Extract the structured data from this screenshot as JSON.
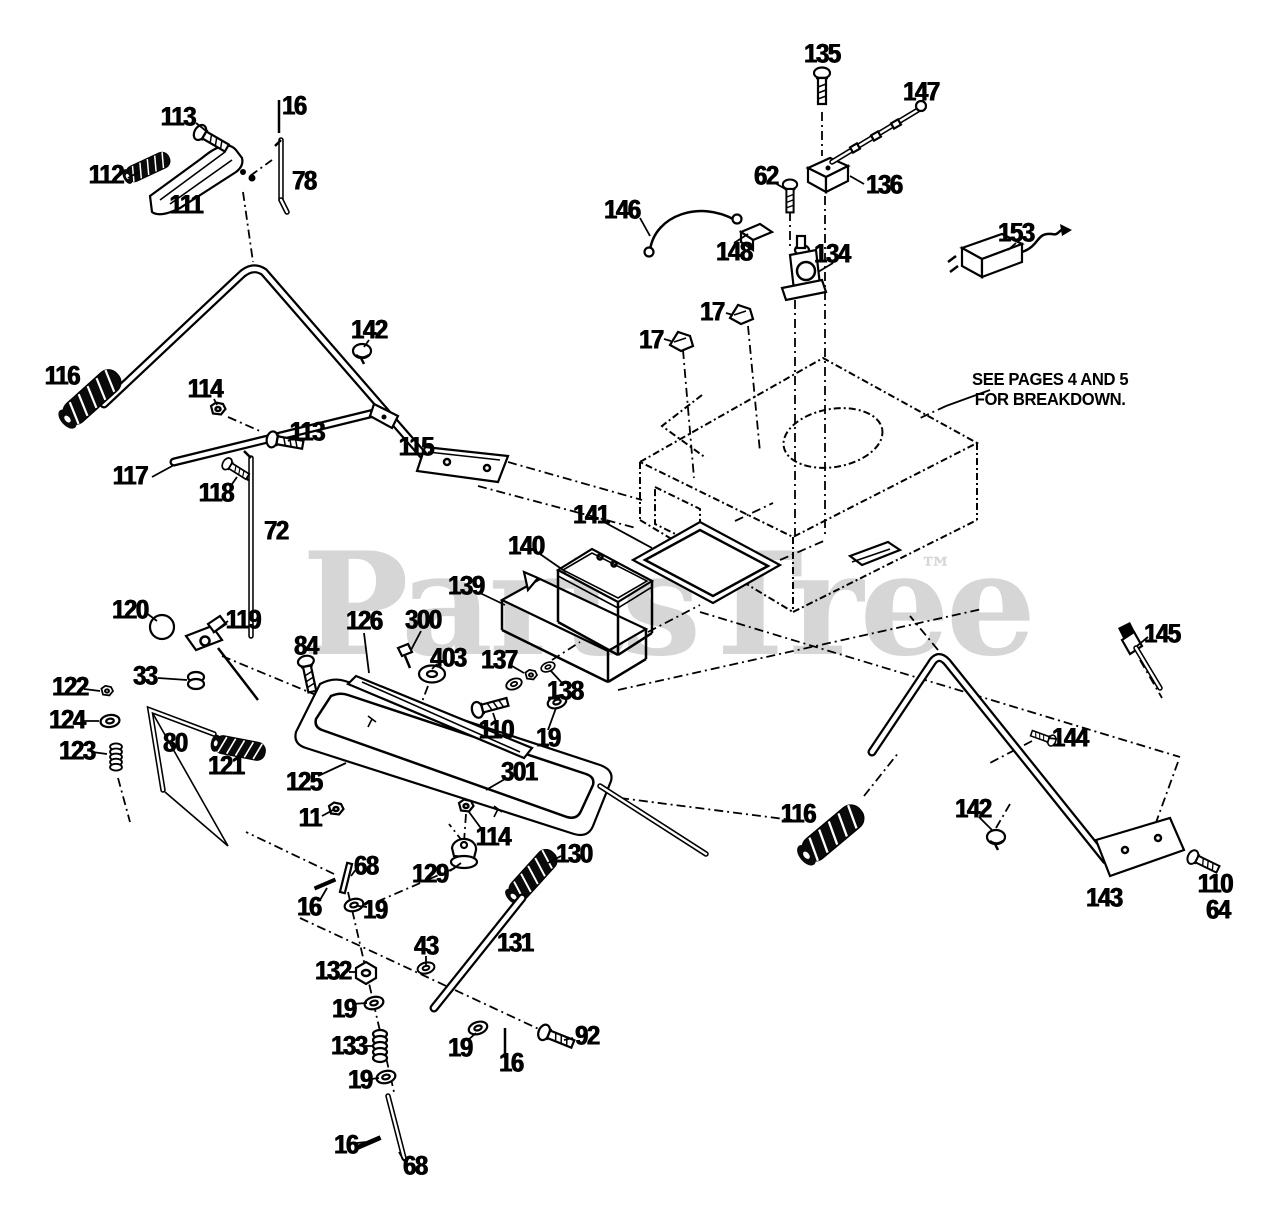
{
  "page": {
    "width": 1280,
    "height": 1224,
    "background": "#ffffff",
    "ink_color": "#000000"
  },
  "watermark": {
    "text": "PartsTree",
    "tm": "™",
    "color": "#d6d6d6"
  },
  "note": {
    "text": "SEE PAGES 4 AND 5\nFOR BREAKDOWN."
  },
  "diagram": {
    "type": "exploded-parts-diagram",
    "description": "Handle, battery and control linkage exploded view with numbered callouts, dash-dot assembly lines and a dashed chassis deck marked for breakdown on other pages."
  },
  "labels": [
    {
      "text": "113",
      "x": 178,
      "y": 117
    },
    {
      "text": "16",
      "x": 294,
      "y": 106
    },
    {
      "text": "112",
      "x": 106,
      "y": 175
    },
    {
      "text": "111",
      "x": 186,
      "y": 205
    },
    {
      "text": "78",
      "x": 304,
      "y": 181
    },
    {
      "text": "135",
      "x": 822,
      "y": 54
    },
    {
      "text": "147",
      "x": 921,
      "y": 92
    },
    {
      "text": "62",
      "x": 766,
      "y": 176
    },
    {
      "text": "136",
      "x": 884,
      "y": 185
    },
    {
      "text": "146",
      "x": 622,
      "y": 210
    },
    {
      "text": "148",
      "x": 734,
      "y": 252
    },
    {
      "text": "134",
      "x": 832,
      "y": 254
    },
    {
      "text": "153",
      "x": 1016,
      "y": 233
    },
    {
      "text": "17",
      "x": 712,
      "y": 312
    },
    {
      "text": "17",
      "x": 651,
      "y": 340
    },
    {
      "text": "142",
      "x": 369,
      "y": 330
    },
    {
      "text": "116",
      "x": 62,
      "y": 376
    },
    {
      "text": "114",
      "x": 205,
      "y": 389
    },
    {
      "text": "113",
      "x": 307,
      "y": 432
    },
    {
      "text": "115",
      "x": 416,
      "y": 447
    },
    {
      "text": "117",
      "x": 130,
      "y": 476
    },
    {
      "text": "118",
      "x": 216,
      "y": 493
    },
    {
      "text": "72",
      "x": 276,
      "y": 531
    },
    {
      "text": "141",
      "x": 591,
      "y": 515
    },
    {
      "text": "140",
      "x": 526,
      "y": 546
    },
    {
      "text": "139",
      "x": 466,
      "y": 586
    },
    {
      "text": "120",
      "x": 130,
      "y": 610
    },
    {
      "text": "119",
      "x": 243,
      "y": 620
    },
    {
      "text": "126",
      "x": 364,
      "y": 621
    },
    {
      "text": "300",
      "x": 423,
      "y": 620
    },
    {
      "text": "84",
      "x": 306,
      "y": 646
    },
    {
      "text": "403",
      "x": 448,
      "y": 658
    },
    {
      "text": "137",
      "x": 499,
      "y": 660
    },
    {
      "text": "33",
      "x": 145,
      "y": 676
    },
    {
      "text": "122",
      "x": 70,
      "y": 687
    },
    {
      "text": "124",
      "x": 67,
      "y": 720
    },
    {
      "text": "110",
      "x": 496,
      "y": 730
    },
    {
      "text": "19",
      "x": 548,
      "y": 738
    },
    {
      "text": "138",
      "x": 565,
      "y": 691
    },
    {
      "text": "123",
      "x": 77,
      "y": 751
    },
    {
      "text": "80",
      "x": 175,
      "y": 743
    },
    {
      "text": "121",
      "x": 226,
      "y": 766
    },
    {
      "text": "125",
      "x": 304,
      "y": 782
    },
    {
      "text": "301",
      "x": 519,
      "y": 772
    },
    {
      "text": "11",
      "x": 310,
      "y": 818
    },
    {
      "text": "114",
      "x": 493,
      "y": 837
    },
    {
      "text": "129",
      "x": 430,
      "y": 874
    },
    {
      "text": "130",
      "x": 574,
      "y": 854
    },
    {
      "text": "68",
      "x": 366,
      "y": 866
    },
    {
      "text": "16",
      "x": 309,
      "y": 907
    },
    {
      "text": "19",
      "x": 375,
      "y": 910
    },
    {
      "text": "131",
      "x": 515,
      "y": 943
    },
    {
      "text": "43",
      "x": 426,
      "y": 946
    },
    {
      "text": "132",
      "x": 333,
      "y": 971
    },
    {
      "text": "19",
      "x": 344,
      "y": 1009
    },
    {
      "text": "133",
      "x": 349,
      "y": 1046
    },
    {
      "text": "19",
      "x": 460,
      "y": 1048
    },
    {
      "text": "92",
      "x": 587,
      "y": 1036
    },
    {
      "text": "16",
      "x": 511,
      "y": 1063
    },
    {
      "text": "19",
      "x": 360,
      "y": 1080
    },
    {
      "text": "16",
      "x": 346,
      "y": 1145
    },
    {
      "text": "68",
      "x": 415,
      "y": 1166
    },
    {
      "text": "145",
      "x": 1162,
      "y": 634
    },
    {
      "text": "144",
      "x": 1070,
      "y": 738
    },
    {
      "text": "116",
      "x": 798,
      "y": 814
    },
    {
      "text": "142",
      "x": 973,
      "y": 809
    },
    {
      "text": "143",
      "x": 1104,
      "y": 898
    },
    {
      "text": "110",
      "x": 1215,
      "y": 884
    },
    {
      "text": "64",
      "x": 1218,
      "y": 910
    }
  ]
}
